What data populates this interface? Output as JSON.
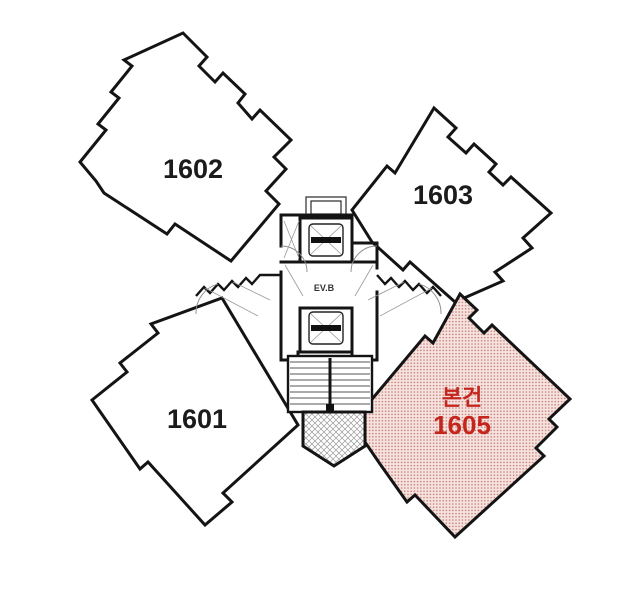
{
  "diagram": {
    "type": "apartment-floor-plan",
    "core_label": "EV.B",
    "units": [
      {
        "number": "1601",
        "highlighted": false
      },
      {
        "number": "1602",
        "highlighted": false
      },
      {
        "number": "1603",
        "highlighted": false
      },
      {
        "number": "1605",
        "highlighted": true,
        "tag": "본건"
      }
    ],
    "colors": {
      "outline": "#141414",
      "highlight_fill_bg": "#f5e3e0",
      "highlight_dot": "#cf867f",
      "highlight_text": "#c4261d",
      "thin_line": "#999999"
    }
  }
}
